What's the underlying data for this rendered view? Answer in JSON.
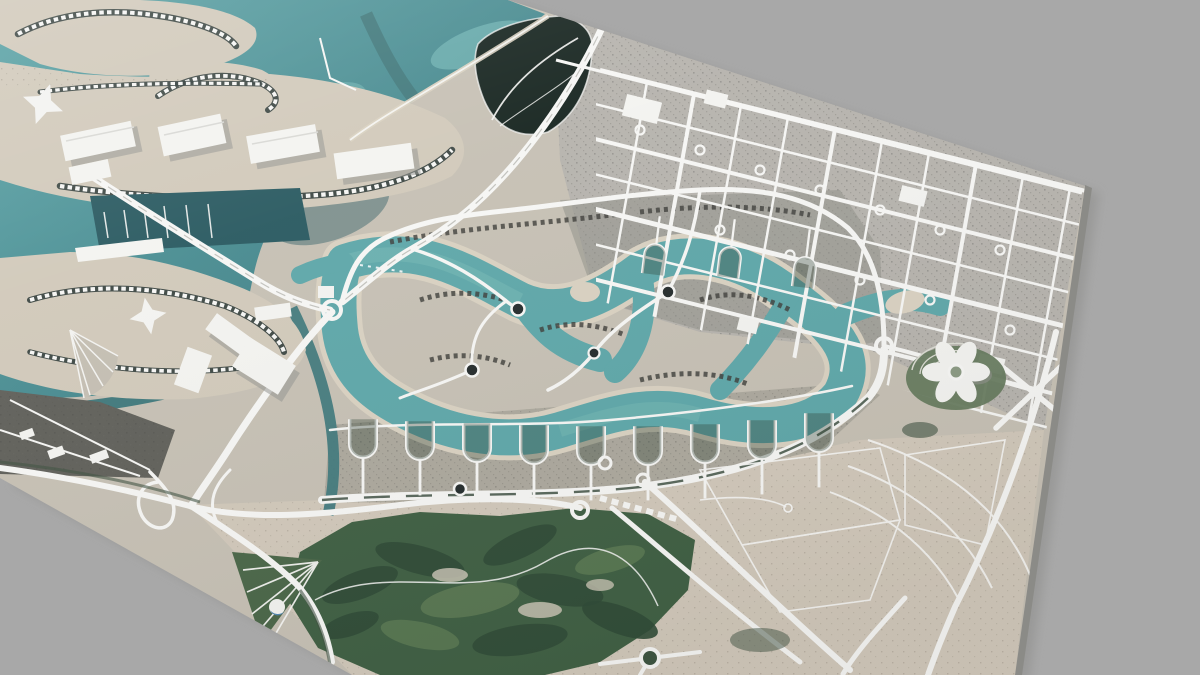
{
  "meta": {
    "scene": "tilted-3d-aerial-city-model",
    "description": "Perspective render of a textured satellite terrain tile: coastal resort islands, winding lagoon with villa islands, suburban road grid, highways, interchanges and a golf course on a plain gray backdrop",
    "visible_text": ""
  },
  "colors": {
    "bg": "#a8a8a8",
    "shadow": "#8d8d8b",
    "skirt": "#8b8b87",
    "land": "#c6c0b4",
    "landUrban": "#b6b3ad",
    "landSand": "#d1c9ba",
    "landDark": "#60605a",
    "villaBand": "#a8a59a",
    "sea": "#47868c",
    "seaDeep": "#2a5a61",
    "seaShallow": "#79bcba",
    "lagoon": "#5ea7a9",
    "lagoonLight": "#74b8b4",
    "beach": "#d9d1c1",
    "canal": "#41797c",
    "mangrove": "#16241f",
    "golf": "#3f5f43",
    "golfDark": "#2f4a36",
    "golfLight": "#5d7a54",
    "park": "#4a6648",
    "green": "#3f5141",
    "road": "#f6f6f4",
    "roadMedian": "#c2c2bd",
    "medianGreen": "#47584a",
    "streetDark": "#2f3b38",
    "building": "#f3f3f0",
    "buildingShadow": "#94948f",
    "roundDark": "#242b2c",
    "roundGreen": "#3c5440",
    "speckDark": "#3c3c38",
    "domeBlue": "#4f86b2",
    "mound": "#667a5e"
  }
}
